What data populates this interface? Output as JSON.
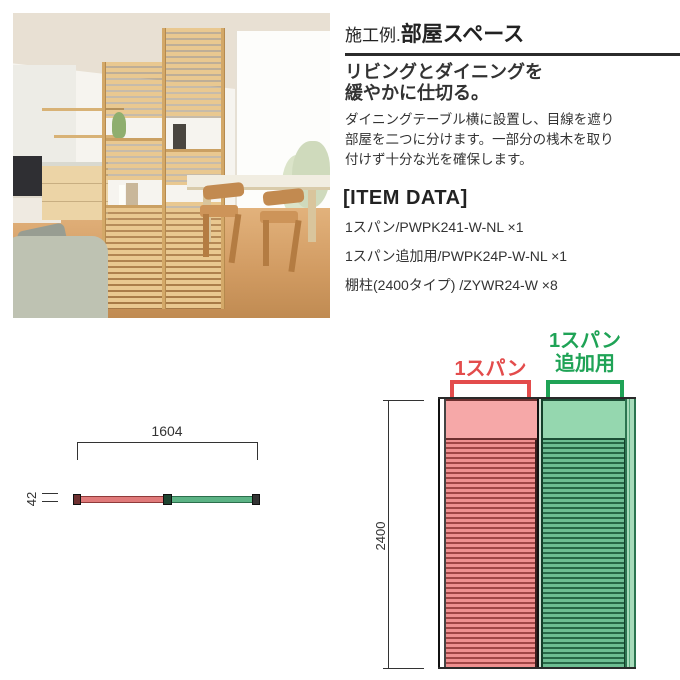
{
  "colors": {
    "span_red": "#e34c4c",
    "addon_green": "#1fa356",
    "diagram_line": "#333333"
  },
  "info": {
    "title_prefix": "施工例.",
    "title_main": "部屋スペース",
    "subtitle_line1": "リビングとダイニングを",
    "subtitle_line2": "緩やかに仕切る。",
    "description_line1": "ダイニングテーブル横に設置し、目線を遮り",
    "description_line2": "部屋を二つに分けます。一部分の桟木を取り",
    "description_line3": "付けず十分な光を確保します。",
    "item_data_heading": "[ITEM DATA]",
    "items": [
      "1スパン/PWPK241-W-NL ×1",
      "1スパン追加用/PWPK24P-W-NL ×1",
      "棚柱(2400タイプ) /ZYWR24-W ×8"
    ]
  },
  "diagram_top_view": {
    "width_label": "1604",
    "depth_label": "42"
  },
  "diagram_front_view": {
    "height_label": "2400",
    "span_label": "1スパン",
    "addon_label_line1": "1スパン",
    "addon_label_line2": "追加用"
  }
}
